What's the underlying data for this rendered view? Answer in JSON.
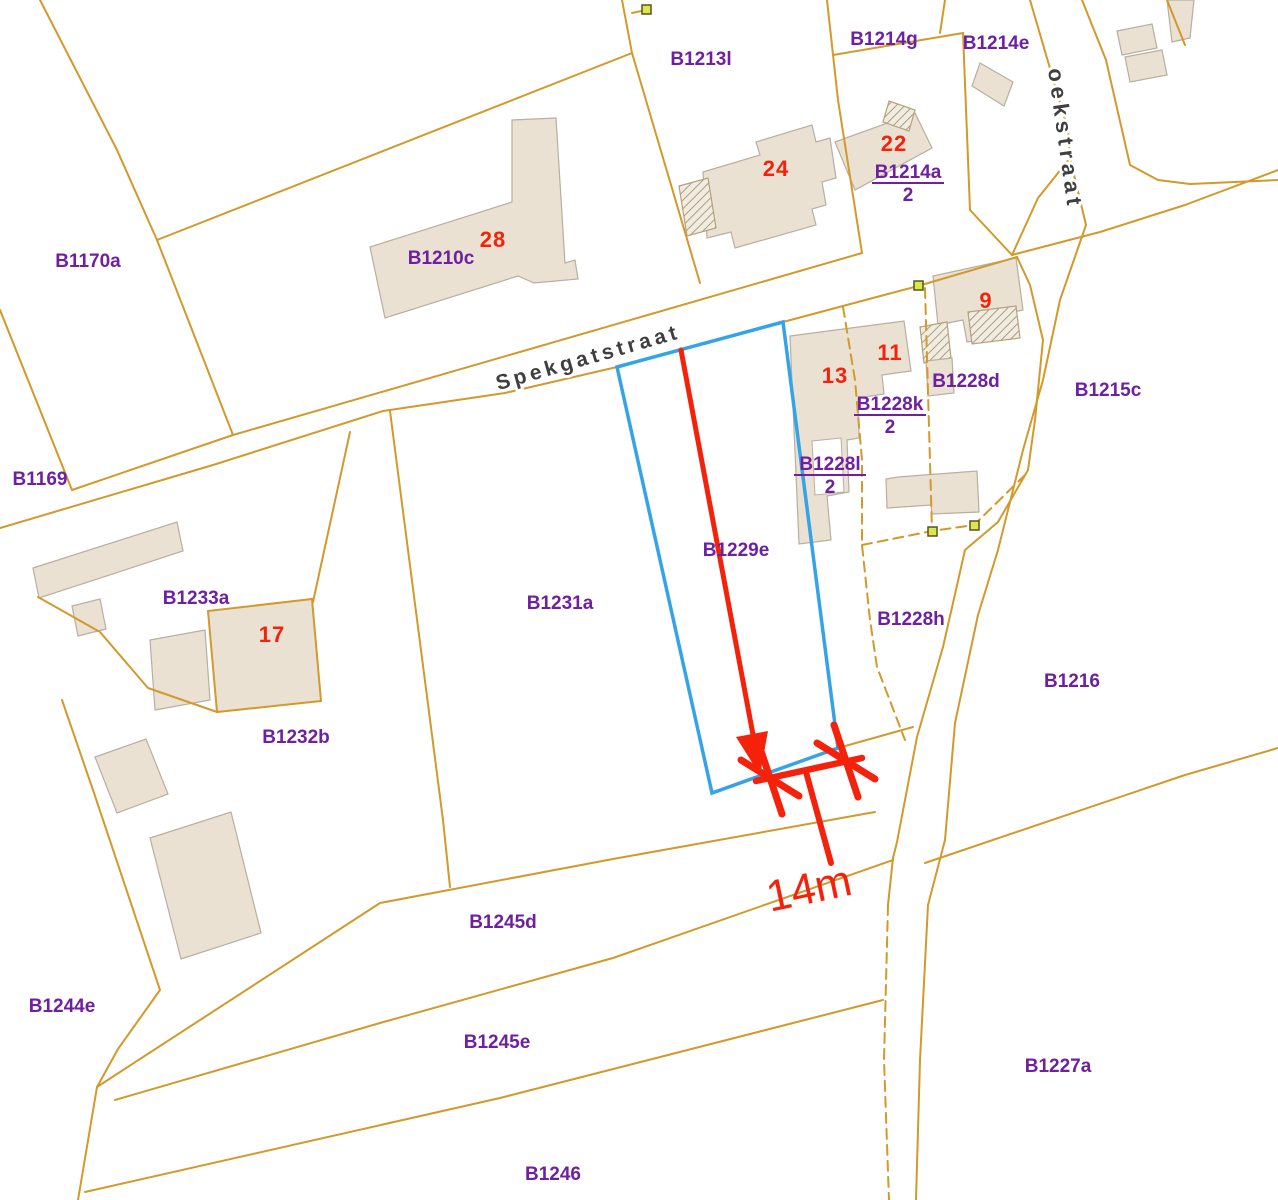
{
  "map": {
    "colors": {
      "parcel_line": "#d2992b",
      "building_fill": "#eae1d2",
      "building_stroke": "#b7af9f",
      "hatch_line": "#90897c",
      "highlight": "#35a3e8",
      "annotation": "#f5220b",
      "parcel_label": "#6e20a0",
      "street_label": "#3f3f3f",
      "marker_fill": "#dde64c",
      "marker_stroke": "#55551f",
      "background": "#ffffff"
    },
    "highlighted_parcel": "B1229e",
    "street_labels": [
      {
        "text": "Spekgatstraat",
        "x": 590,
        "y": 364,
        "rotation": -16,
        "letter_spacing": 4,
        "font_size": 21
      },
      {
        "text": "oekstraat",
        "x": 1058,
        "y": 140,
        "rotation": 82,
        "letter_spacing": 5,
        "font_size": 22
      }
    ],
    "parcel_labels": [
      {
        "text": "B1170a",
        "x": 88,
        "y": 267
      },
      {
        "text": "B1210c",
        "x": 441,
        "y": 264
      },
      {
        "text": "B1213l",
        "x": 701,
        "y": 65
      },
      {
        "text": "B1214g",
        "x": 884,
        "y": 45
      },
      {
        "text": "B1214e",
        "x": 996,
        "y": 49
      },
      {
        "text": "B1215c",
        "x": 1108,
        "y": 396
      },
      {
        "text": "B1228d",
        "x": 966,
        "y": 387
      },
      {
        "text": "B1229e",
        "x": 736,
        "y": 556
      },
      {
        "text": "B1231a",
        "x": 560,
        "y": 609
      },
      {
        "text": "B1228h",
        "x": 911,
        "y": 625
      },
      {
        "text": "B1216",
        "x": 1072,
        "y": 687
      },
      {
        "text": "B1169",
        "x": 40,
        "y": 485
      },
      {
        "text": "B1233a",
        "x": 196,
        "y": 604
      },
      {
        "text": "B1232b",
        "x": 296,
        "y": 743
      },
      {
        "text": "B1244e",
        "x": 62,
        "y": 1012
      },
      {
        "text": "B1245d",
        "x": 503,
        "y": 928
      },
      {
        "text": "B1245e",
        "x": 497,
        "y": 1048
      },
      {
        "text": "B1227a",
        "x": 1058,
        "y": 1072
      },
      {
        "text": "B1246",
        "x": 553,
        "y": 1180
      }
    ],
    "fraction_parcel_labels": [
      {
        "numerator": "B1214a",
        "denominator": "2",
        "x": 908,
        "y": 178
      },
      {
        "numerator": "B1228k",
        "denominator": "2",
        "x": 890,
        "y": 410
      },
      {
        "numerator": "B1228l",
        "denominator": "2",
        "x": 830,
        "y": 470
      }
    ],
    "house_numbers": [
      {
        "text": "28",
        "x": 493,
        "y": 247
      },
      {
        "text": "24",
        "x": 776,
        "y": 176
      },
      {
        "text": "22",
        "x": 894,
        "y": 151
      },
      {
        "text": "9",
        "x": 986,
        "y": 308
      },
      {
        "text": "11",
        "x": 890,
        "y": 360
      },
      {
        "text": "13",
        "x": 835,
        "y": 383
      },
      {
        "text": "17",
        "x": 272,
        "y": 642
      }
    ],
    "measurement": {
      "label": "14m",
      "x": 812,
      "y": 903,
      "rotation": -12
    }
  }
}
